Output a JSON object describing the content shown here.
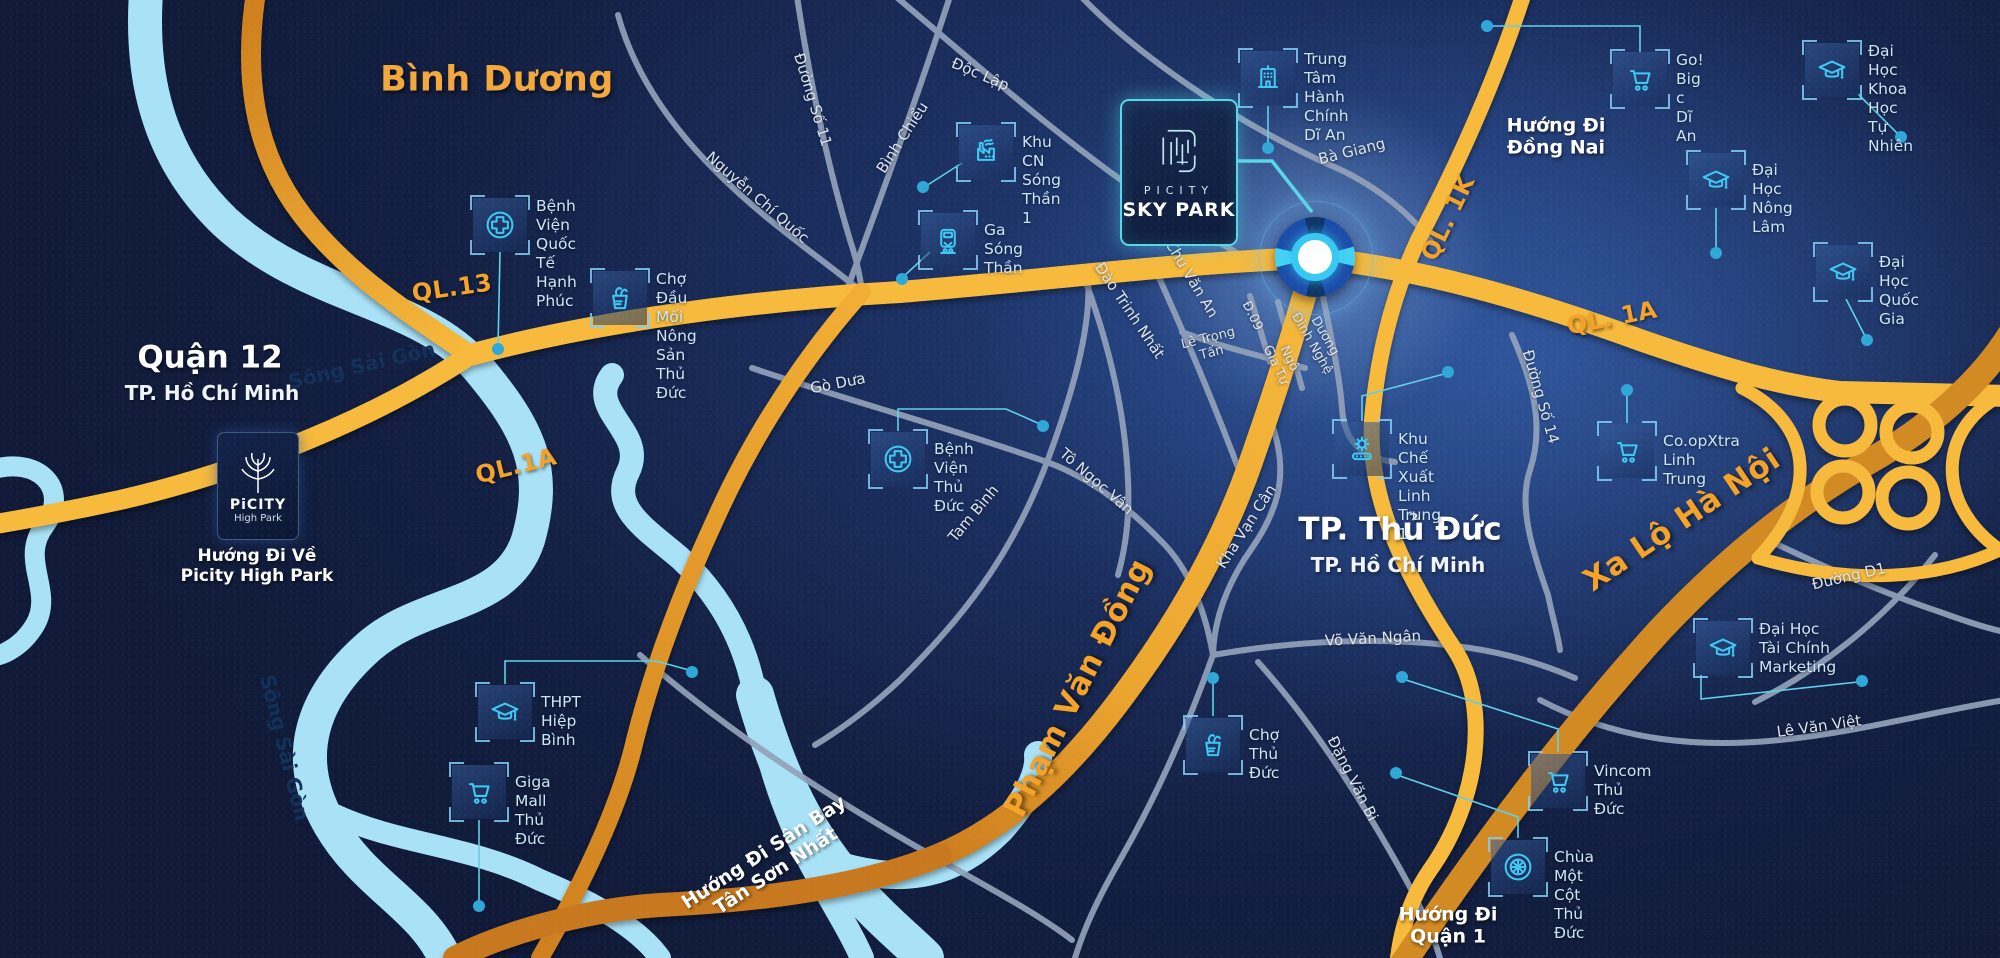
{
  "colors": {
    "background": "#131F41",
    "river": "#A9E2F7",
    "road_yellow": "#F7BA3C",
    "road_orange_dark": "#D0831F",
    "road_gray": "#93A2BA",
    "poi_teal": "#3FC9F2",
    "label_orange": "#F4A228",
    "card_border_teal": "#57D7E8"
  },
  "project": {
    "sky_park": {
      "brand": "PICITY",
      "name": "SKY PARK"
    },
    "high_park": {
      "brand": "PiCITY",
      "name": "High Park"
    }
  },
  "labels": [
    {
      "id": "binh-duong",
      "t": "Bình Dương",
      "x": 497,
      "y": 80,
      "rot": 0,
      "cls": "region-orange"
    },
    {
      "id": "quan-12",
      "t": "Quận 12",
      "x": 210,
      "y": 358,
      "rot": 0,
      "cls": "region-white"
    },
    {
      "id": "quan-12-city",
      "t": "TP. Hồ Chí Minh",
      "x": 212,
      "y": 394,
      "rot": 0,
      "cls": "region-sub"
    },
    {
      "id": "tp-thu-duc",
      "t": "TP. Thủ Đức",
      "x": 1400,
      "y": 530,
      "rot": 0,
      "cls": "region-white"
    },
    {
      "id": "tp-thu-duc-city",
      "t": "TP. Hồ Chí Minh",
      "x": 1398,
      "y": 566,
      "rot": 0,
      "cls": "region-sub"
    },
    {
      "id": "huong-di-dong-nai",
      "t": "Hướng Đi\nĐồng Nai",
      "x": 1556,
      "y": 137,
      "rot": 0,
      "cls": "direction"
    },
    {
      "id": "huong-di-quan-1",
      "t": "Hướng Đi\nQuận 1",
      "x": 1448,
      "y": 926,
      "rot": 0,
      "cls": "direction"
    },
    {
      "id": "huong-di-ve-picity",
      "t": "Hướng Đi Về\nPicity High Park",
      "x": 257,
      "y": 566,
      "rot": 0,
      "cls": "direction-sm"
    },
    {
      "id": "huong-di-san-bay",
      "t": "Hướng Đi Sân Bay\nTân Sơn Nhất",
      "x": 770,
      "y": 862,
      "rot": -33,
      "cls": "direction"
    },
    {
      "id": "ql13",
      "t": "QL.13",
      "x": 452,
      "y": 288,
      "rot": -8,
      "cls": "road"
    },
    {
      "id": "ql1a-left",
      "t": "QL.1A",
      "x": 516,
      "y": 466,
      "rot": -14,
      "cls": "road"
    },
    {
      "id": "ql1a-right",
      "t": "QL. 1A",
      "x": 1612,
      "y": 318,
      "rot": -11,
      "cls": "road"
    },
    {
      "id": "ql1k",
      "t": "QL. 1K",
      "x": 1448,
      "y": 218,
      "rot": -64,
      "cls": "road"
    },
    {
      "id": "xa-lo-ha-noi",
      "t": "Xa Lộ Hà Nội",
      "x": 1682,
      "y": 520,
      "rot": -34,
      "cls": "road-lg"
    },
    {
      "id": "pham-van-dong",
      "t": "Phạm Văn Đồng",
      "x": 1078,
      "y": 688,
      "rot": -63,
      "cls": "road-lg"
    },
    {
      "id": "song-sai-gon-1",
      "t": "Sông Sài Gòn",
      "x": 362,
      "y": 366,
      "rot": -13,
      "cls": "river"
    },
    {
      "id": "song-sai-gon-2",
      "t": "Sông Sài Gòn",
      "x": 284,
      "y": 748,
      "rot": 76,
      "cls": "river"
    },
    {
      "id": "duong-so-11",
      "t": "Đường Số 11",
      "x": 812,
      "y": 100,
      "rot": 73,
      "cls": "street"
    },
    {
      "id": "doc-lap",
      "t": "Độc Lập",
      "x": 980,
      "y": 75,
      "rot": 23,
      "cls": "street"
    },
    {
      "id": "binh-chieu",
      "t": "Bình Chiểu",
      "x": 903,
      "y": 138,
      "rot": -57,
      "cls": "street"
    },
    {
      "id": "nguyen-chi-quoc",
      "t": "Nguyễn Chí Quốc",
      "x": 757,
      "y": 198,
      "rot": 41,
      "cls": "street"
    },
    {
      "id": "ba-giang",
      "t": "Bà Giang",
      "x": 1352,
      "y": 152,
      "rot": -14,
      "cls": "street"
    },
    {
      "id": "go-dua",
      "t": "Gò Dưa",
      "x": 838,
      "y": 384,
      "rot": -11,
      "cls": "street"
    },
    {
      "id": "tam-binh",
      "t": "Tam Bình",
      "x": 974,
      "y": 514,
      "rot": -50,
      "cls": "street"
    },
    {
      "id": "to-ngoc-van",
      "t": "Tô Ngọc Vân",
      "x": 1096,
      "y": 482,
      "rot": 41,
      "cls": "street"
    },
    {
      "id": "dao-trinh-nhat",
      "t": "Đào Trinh Nhất",
      "x": 1129,
      "y": 311,
      "rot": 56,
      "cls": "street"
    },
    {
      "id": "chu-van-an",
      "t": "Chu Văn An",
      "x": 1191,
      "y": 279,
      "rot": 59,
      "cls": "street"
    },
    {
      "id": "le-trong-tan",
      "t": "Lê Trọng\nTấn",
      "x": 1210,
      "y": 346,
      "rot": -14,
      "cls": "street-sm"
    },
    {
      "id": "d-09",
      "t": "Đ.09",
      "x": 1252,
      "y": 316,
      "rot": 64,
      "cls": "street-sm"
    },
    {
      "id": "ngo-gia-tu",
      "t": "Ngô\nGia Tự",
      "x": 1282,
      "y": 362,
      "rot": 64,
      "cls": "street-sm"
    },
    {
      "id": "duong-dinh-nghe",
      "t": "Dương\nĐình Nghệ",
      "x": 1318,
      "y": 340,
      "rot": 60,
      "cls": "street-sm"
    },
    {
      "id": "kha-van-can",
      "t": "Kha Vạn Cân",
      "x": 1247,
      "y": 527,
      "rot": -57,
      "cls": "street"
    },
    {
      "id": "vo-van-ngan",
      "t": "Võ Văn Ngân",
      "x": 1373,
      "y": 639,
      "rot": -3,
      "cls": "street"
    },
    {
      "id": "dang-van-bi",
      "t": "Đặng Văn Bi",
      "x": 1352,
      "y": 779,
      "rot": 63,
      "cls": "street"
    },
    {
      "id": "duong-so-14",
      "t": "Đường Số 14",
      "x": 1540,
      "y": 397,
      "rot": 74,
      "cls": "street"
    },
    {
      "id": "duong-d1",
      "t": "Đường D1",
      "x": 1849,
      "y": 577,
      "rot": -13,
      "cls": "street"
    },
    {
      "id": "le-van-viet",
      "t": "Lê Văn Việt",
      "x": 1819,
      "y": 727,
      "rot": -8,
      "cls": "street"
    }
  ],
  "pois": [
    {
      "id": "benh-vien-quoc-te-hanh-phuc",
      "icon": "hospital",
      "x": 500,
      "y": 225,
      "lines": [
        "Bệnh Viện",
        "Quốc Tế",
        "Hạnh Phúc"
      ]
    },
    {
      "id": "cho-dau-moi-nong-san",
      "icon": "market",
      "x": 620,
      "y": 298,
      "lines": [
        "Chợ Đầu Mối",
        "Nông Sản",
        "Thủ Đức"
      ]
    },
    {
      "id": "khu-cn-song-than-1",
      "icon": "factory",
      "x": 986,
      "y": 152,
      "lines": [
        "Khu CN",
        "Sóng Thần 1"
      ]
    },
    {
      "id": "ga-song-than",
      "icon": "train",
      "x": 948,
      "y": 240,
      "lines": [
        "Ga",
        "Sóng Thần"
      ]
    },
    {
      "id": "trung-tam-hanh-chinh-di-an",
      "icon": "building",
      "x": 1268,
      "y": 78,
      "lines": [
        "Trung Tâm",
        "Hành Chính",
        "Dĩ An"
      ]
    },
    {
      "id": "go-big-c-di-an",
      "icon": "cart",
      "x": 1640,
      "y": 79,
      "lines": [
        "Go!",
        "Big c",
        "Dĩ An"
      ]
    },
    {
      "id": "dai-hoc-khoa-hoc-tu-nhien",
      "icon": "graduation-cap",
      "x": 1832,
      "y": 70,
      "lines": [
        "Đại Học",
        "Khoa Học",
        "Tự Nhiên"
      ]
    },
    {
      "id": "dai-hoc-nong-lam",
      "icon": "graduation-cap",
      "x": 1716,
      "y": 180,
      "lines": [
        "Đại Học",
        "Nông Lâm"
      ]
    },
    {
      "id": "dai-hoc-quoc-gia",
      "icon": "graduation-cap",
      "x": 1843,
      "y": 272,
      "lines": [
        "Đại Học",
        "Quốc Gia"
      ]
    },
    {
      "id": "benh-vien-thu-duc",
      "icon": "hospital",
      "x": 898,
      "y": 459,
      "lines": [
        "Bệnh Viện",
        "Thủ Đức"
      ]
    },
    {
      "id": "khu-che-xuat-linh-trung-1",
      "icon": "gear",
      "x": 1362,
      "y": 449,
      "lines": [
        "Khu Chế Xuất",
        "Linh Trung 1"
      ]
    },
    {
      "id": "coopxtra-linh-trung",
      "icon": "cart",
      "x": 1627,
      "y": 451,
      "lines": [
        "Co.opXtra",
        "Linh Trung"
      ]
    },
    {
      "id": "dai-hoc-tai-chinh-marketing",
      "icon": "graduation-cap",
      "x": 1723,
      "y": 648,
      "lines": [
        "Đại Học",
        "Tài Chính",
        "Marketing"
      ]
    },
    {
      "id": "thpt-hiep-binh",
      "icon": "graduation-cap",
      "x": 505,
      "y": 712,
      "lines": [
        "THPT",
        "Hiệp Bình"
      ]
    },
    {
      "id": "giga-mall-thu-duc",
      "icon": "cart",
      "x": 479,
      "y": 792,
      "lines": [
        "Giga Mall",
        "Thủ Đức"
      ]
    },
    {
      "id": "cho-thu-duc",
      "icon": "market",
      "x": 1213,
      "y": 745,
      "lines": [
        "Chợ",
        "Thủ Đức"
      ]
    },
    {
      "id": "vincom-thu-duc",
      "icon": "cart",
      "x": 1558,
      "y": 781,
      "lines": [
        "Vincom",
        "Thủ Đức"
      ]
    },
    {
      "id": "chua-mot-cot-thu-duc",
      "icon": "dharma-wheel",
      "x": 1518,
      "y": 867,
      "lines": [
        "Chùa Một Cột",
        "Thủ Đức"
      ]
    }
  ]
}
